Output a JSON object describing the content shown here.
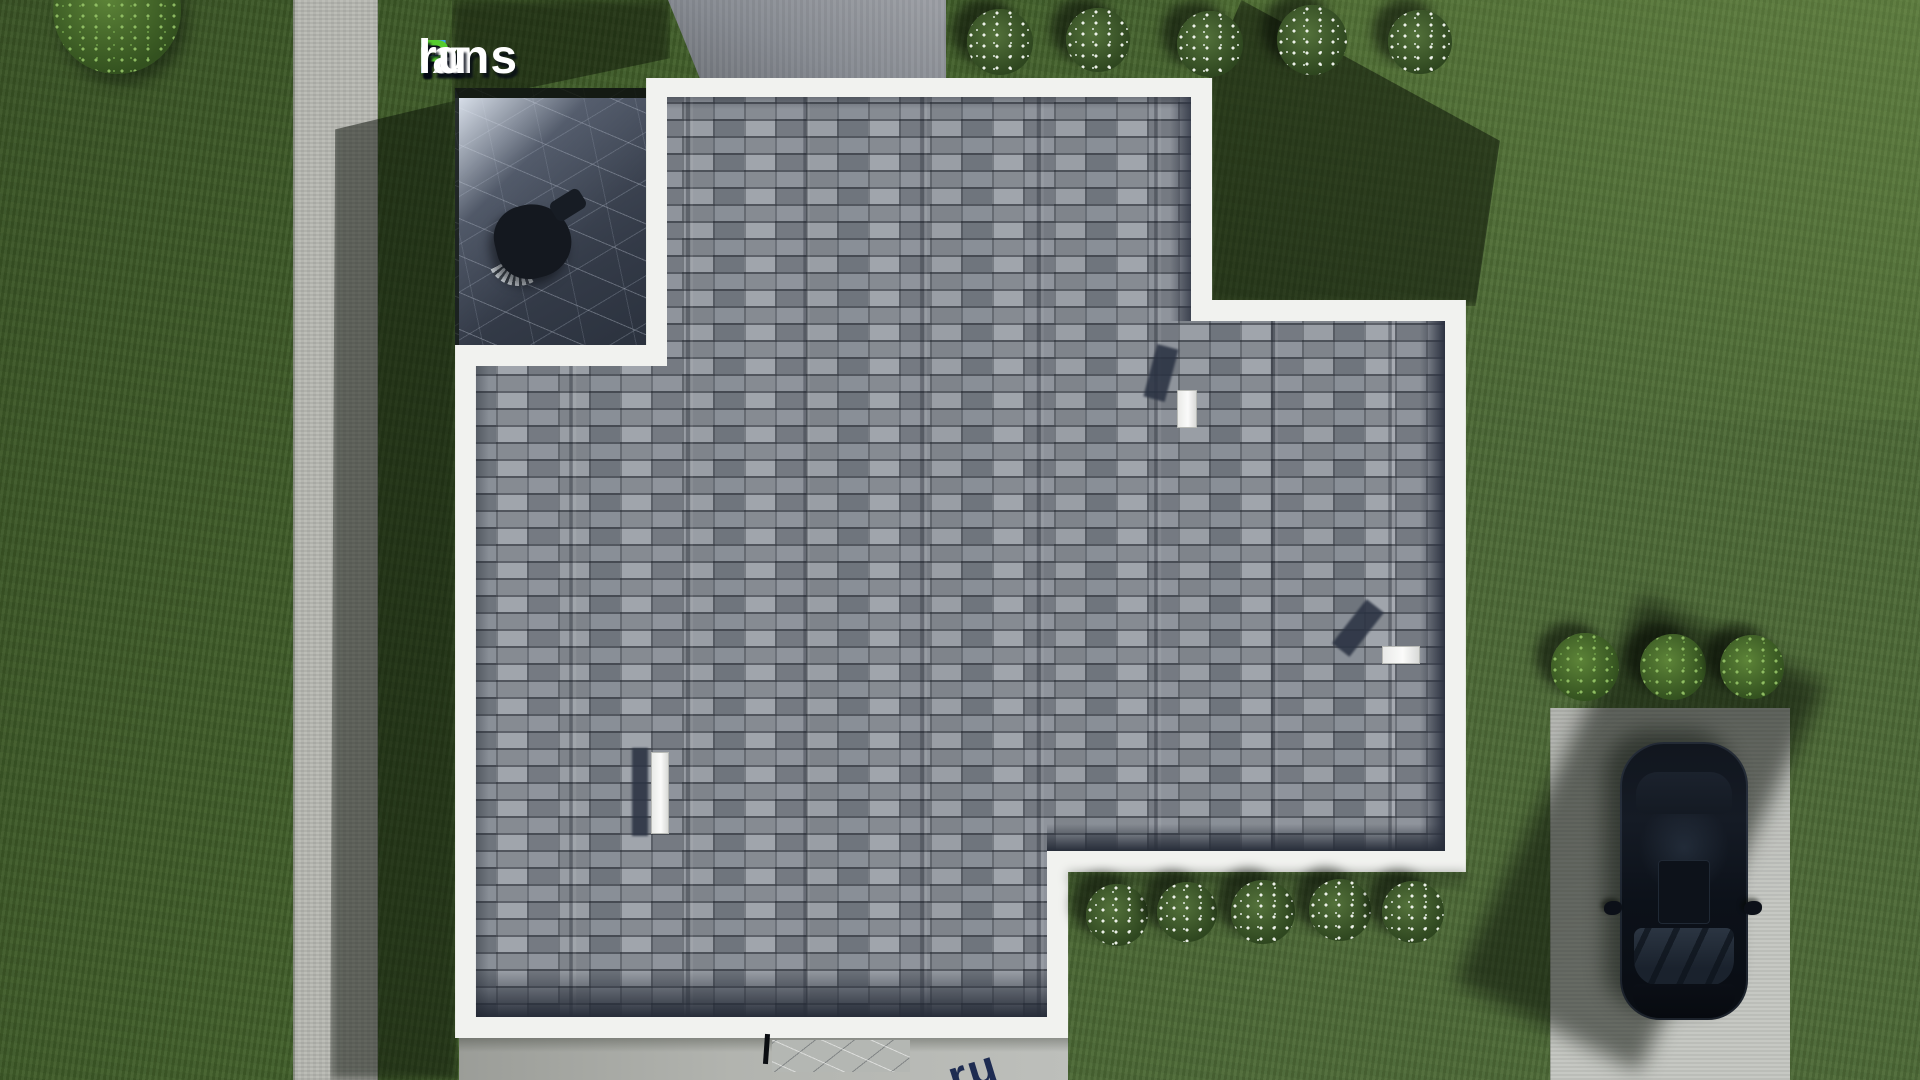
{
  "brand": {
    "parts": [
      {
        "text": "F",
        "color": "#3aa7ea"
      },
      {
        "text": "ix",
        "color": "#ffffff"
      },
      {
        "text": "P",
        "color": "#55cc2e"
      },
      {
        "text": "lans",
        "color": "#ffffff"
      },
      {
        "text": ".",
        "color": "#2f72e4"
      },
      {
        "text": "ru",
        "color": "#ffffff"
      }
    ],
    "corner_watermark_text": "ru",
    "pad_dashes": [
      {
        "w": 30,
        "color": "#e8e9e6"
      },
      {
        "w": 26,
        "color": "#e8e9e6"
      },
      {
        "w": 22,
        "color": "#e8e9e6"
      },
      {
        "w": 12,
        "color": "#2456c8"
      },
      {
        "w": 20,
        "color": "#e8e9e6"
      },
      {
        "w": 28,
        "color": "#e8e9e6"
      },
      {
        "w": 18,
        "color": "#e8e9e6"
      }
    ]
  },
  "colors": {
    "grass": "#44622c",
    "concrete_path": "#b6b7b1",
    "driveway": "#c3c5c0",
    "roof_shingle": "#8a8f97",
    "roof_border_white": "#f1f2ef",
    "terrace_stone": "#3c4350",
    "car_paint": "#0c1119"
  },
  "landscaping": {
    "bush_top_left": {
      "x": 117,
      "y": 10,
      "size": 128
    },
    "bushes_flowering_top": [
      {
        "x": 1000,
        "y": 42,
        "size": 66
      },
      {
        "x": 1098,
        "y": 40,
        "size": 64
      },
      {
        "x": 1210,
        "y": 44,
        "size": 66
      },
      {
        "x": 1312,
        "y": 40,
        "size": 70
      },
      {
        "x": 1420,
        "y": 42,
        "size": 64
      }
    ],
    "bushes_flowering_bottom": [
      {
        "x": 1117,
        "y": 915,
        "size": 62
      },
      {
        "x": 1187,
        "y": 912,
        "size": 60
      },
      {
        "x": 1263,
        "y": 912,
        "size": 64
      },
      {
        "x": 1340,
        "y": 910,
        "size": 62
      },
      {
        "x": 1413,
        "y": 912,
        "size": 62
      }
    ],
    "bushes_green_right": [
      {
        "x": 1585,
        "y": 667,
        "size": 68
      },
      {
        "x": 1673,
        "y": 667,
        "size": 66
      },
      {
        "x": 1752,
        "y": 667,
        "size": 64
      }
    ]
  },
  "roof_vents": [
    {
      "x": 1177,
      "y": 390,
      "w": 20,
      "h": 38,
      "shadow": {
        "x": 1150,
        "y": 346,
        "w": 22,
        "h": 54,
        "rot": 15
      }
    },
    {
      "x": 1382,
      "y": 646,
      "w": 38,
      "h": 18,
      "shadow": {
        "x": 1347,
        "y": 600,
        "w": 22,
        "h": 56,
        "rot": 38
      }
    },
    {
      "x": 651,
      "y": 752,
      "w": 18,
      "h": 82,
      "shadow": {
        "x": 632,
        "y": 748,
        "w": 16,
        "h": 88,
        "rot": 0
      }
    }
  ]
}
